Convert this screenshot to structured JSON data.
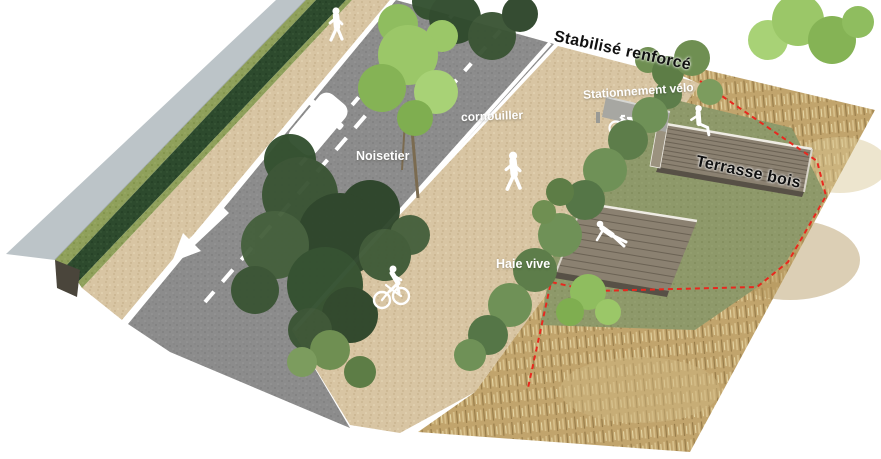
{
  "scene": {
    "type": "axonometric-landscape-plan",
    "background": "#ffffff"
  },
  "annotations": [
    {
      "id": "stabilise-renforce",
      "text": "Stabilisé renforcé",
      "color": "#111111"
    },
    {
      "id": "stationnement-velo",
      "text": "Stationnement vélo",
      "color": "#ffffff"
    },
    {
      "id": "cornouiller",
      "text": "cornouiller",
      "color": "#ffffff"
    },
    {
      "id": "noisetier",
      "text": "Noisetier",
      "color": "#ffffff"
    },
    {
      "id": "terrasse-bois",
      "text": "Terrasse bois",
      "color": "#111111"
    },
    {
      "id": "haie-vive",
      "text": "Haie vive",
      "color": "#ffffff"
    }
  ],
  "features": [
    "sidewalk",
    "hedge",
    "gravel-path",
    "road-with-markings",
    "stabilized-plaza",
    "living-hedge",
    "wood-terrace-upper",
    "wood-terrace-lower",
    "bike-parking",
    "meadow-grass",
    "lawn",
    "project-boundary"
  ],
  "figures": [
    "pedestrian-walking-top",
    "pedestrian-walking-center",
    "cyclist",
    "person-sitting-terrace",
    "person-lounging-terrace"
  ],
  "vehicles": [
    "parked-car"
  ],
  "boundary": {
    "style": "red-dashed",
    "color": "#e8281e"
  },
  "colors": {
    "road": "#8c8c8c",
    "gravel": "#d8c5a3",
    "meadow": "#c1a46c",
    "lawn": "#8e996a",
    "hedge_dark": "#2d4a2d",
    "hedge_light": "#8fa05b",
    "sidewalk": "#bcc4c8",
    "terrace_wood": "#8b8171",
    "marking": "#ffffff"
  }
}
